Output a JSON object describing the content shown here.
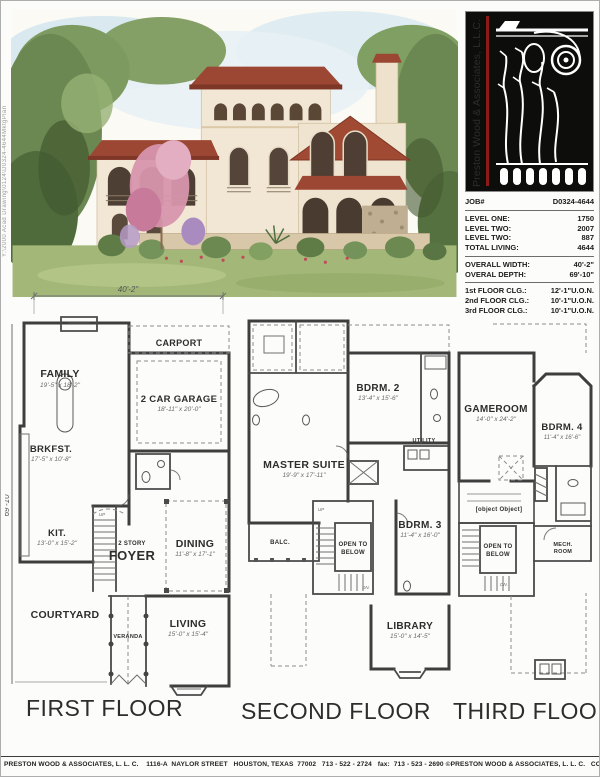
{
  "page": {
    "side_path": "Y:\\2000 Acad Drawing\\0124\\D0324-4644MktgPlan",
    "footer": "PRESTON WOOD & ASSOCIATES, L. L. C.    1116-A  NAYLOR STREET   HOUSTON, TEXAS  77002   713 - 522 - 2724   fax:  713 - 523 - 2690 ©PRESTON WOOD & ASSOCIATES, L. L. C.   COPYRIGHT"
  },
  "colors": {
    "logo_bg": "#0d0d0c",
    "logo_accent_red": "#8e1a18",
    "wall": "#3e3e3e",
    "roof_terracotta": "#9c4733"
  },
  "logo": {
    "company_vertical": "Preston Wood & Associates, L.L.C."
  },
  "job_info": {
    "job_label": "JOB#",
    "job_number": "D0324-4644",
    "areas": [
      {
        "label": "LEVEL ONE:",
        "value": "1750"
      },
      {
        "label": "LEVEL TWO:",
        "value": "2007"
      },
      {
        "label": "LEVEL TWO:",
        "value": "887"
      },
      {
        "label": "TOTAL LIVING:",
        "value": "4644"
      }
    ],
    "dims": [
      {
        "label": "OVERALL WIDTH:",
        "value": "40'-2\""
      },
      {
        "label": "OVERAL DEPTH:",
        "value": "69'-10\""
      }
    ],
    "ceilings": [
      {
        "label": "1st FLOOR CLG.:",
        "value": "12'-1\"U.O.N."
      },
      {
        "label": "2nd FLOOR CLG.:",
        "value": "10'-1\"U.O.N."
      },
      {
        "label": "3rd FLOOR CLG.:",
        "value": "10'-1\"U.O.N."
      }
    ]
  },
  "plans": {
    "first": {
      "title": "FIRST FLOOR",
      "width_dim": "40'-2\"",
      "depth_dim": "69'-10\"",
      "rooms": {
        "family": {
          "name": "FAMILY",
          "dims": "19'-5\" x 18'-2\""
        },
        "carport": {
          "name": "CARPORT"
        },
        "garage": {
          "name": "2 CAR GARAGE",
          "dims": "18'-11\" x 20'-0\""
        },
        "brkfst": {
          "name": "BRKFST.",
          "dims": "17'-5\" x 10'-8\""
        },
        "kit": {
          "name": "KIT.",
          "dims": "13'-0\" x 15'-2\""
        },
        "foyer_pre": "2 STORY",
        "foyer": "FOYER",
        "dining": {
          "name": "DINING",
          "dims": "11'-8\" x 17'-1\""
        },
        "courtyard": {
          "name": "COURTYARD"
        },
        "veranda": {
          "name": "VERANDA"
        },
        "living": {
          "name": "LIVING",
          "dims": "15'-0\" x 15'-4\""
        },
        "up": "UP"
      }
    },
    "second": {
      "title": "SECOND FLOOR",
      "rooms": {
        "master": {
          "name": "MASTER SUITE",
          "dims": "19'-9\" x 17'-11\""
        },
        "bdrm2": {
          "name": "BDRM. 2",
          "dims": "13'-4\" x 15'-6\""
        },
        "utility": {
          "name": "UTILITY"
        },
        "balc": {
          "name": "BALC."
        },
        "open_below_1": "OPEN TO",
        "open_below_2": "BELOW",
        "bdrm3": {
          "name": "BDRM. 3",
          "dims": "11'-4\" x 16'-0\""
        },
        "library": {
          "name": "LIBRARY",
          "dims": "15'-0\" x 14'-5\""
        },
        "up": "UP",
        "dn": "DN."
      }
    },
    "third": {
      "title": "THIRD FLOOR",
      "rooms": {
        "gameroom": {
          "name": "GAMEROOM",
          "dims": "14'-0\" x 24'-2\""
        },
        "bdrm4": {
          "name": "BDRM. 4",
          "dims": "11'-4\" x 16'-6\""
        },
        "study_loft": {
          "name": "STUDY LOFT"
        },
        "open_below_1": "OPEN TO",
        "open_below_2": "BELOW",
        "mech_1": "MECH.",
        "mech_2": "ROOM",
        "dn": "DN."
      }
    }
  }
}
